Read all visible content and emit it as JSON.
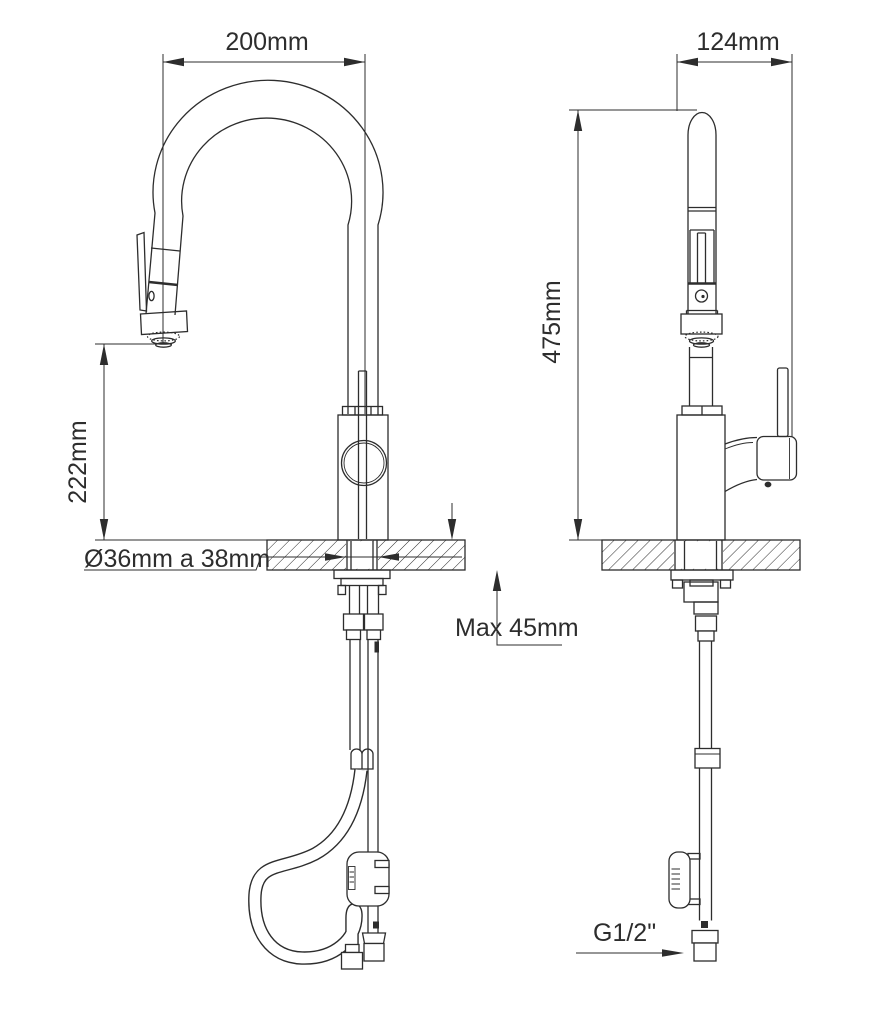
{
  "drawing": {
    "front_view": {
      "spout_reach": "200mm",
      "spout_height_above_deck": "222mm",
      "hole_diameter": "Ø36mm a 38mm",
      "max_deck_thickness": "Max 45mm"
    },
    "side_view": {
      "body_depth": "124mm",
      "overall_height": "475mm",
      "hose_connection": "G1/2\""
    },
    "colors": {
      "ink": "#2d2d2d",
      "background": "#ffffff"
    }
  }
}
